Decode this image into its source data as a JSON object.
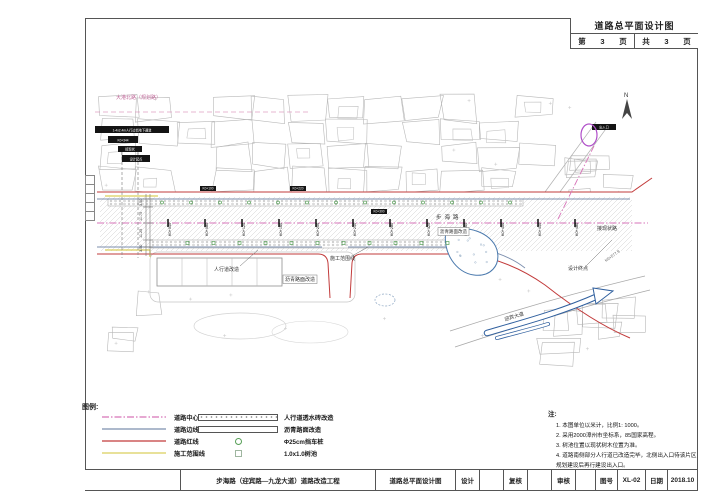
{
  "sheet": {
    "frame_title": "道路总平面设计图",
    "page_row": {
      "p1": "第",
      "p2": "3",
      "p3": "页",
      "p4": "共",
      "p5": "3",
      "p6": "页"
    },
    "bottom_bar": {
      "project": "步海路（迎宾路—九龙大道）道路改造工程",
      "drawing_title": "道路总平面设计图",
      "design_label": "设计",
      "check_label": "复核",
      "review_label": "审核",
      "no_label": "图号",
      "no_value": "XL-02",
      "date_label": "日期",
      "date_value": "2018.10"
    }
  },
  "legend": {
    "heading": "图例:",
    "line_items": [
      {
        "label": "道路中心线",
        "color": "#d773b8",
        "dash": "7 2 1.5 2"
      },
      {
        "label": "道路边线",
        "color": "#7c8fae",
        "dash": ""
      },
      {
        "label": "道路红线",
        "color": "#c23b3b",
        "dash": ""
      },
      {
        "label": "施工范围线",
        "color": "#d9cf5c",
        "dash": ""
      }
    ],
    "symbol_items": [
      {
        "label": "人行道透水砖改造",
        "swatch": "brick"
      },
      {
        "label": "沥青路面改造",
        "swatch": "plain"
      },
      {
        "label": "Φ25cm挡车桩",
        "swatch": "circle"
      },
      {
        "label": "1.0x1.0树池",
        "swatch": "square"
      }
    ]
  },
  "notes": {
    "heading": "注:",
    "items": [
      "1. 本图单位以米计，比例1: 1000。",
      "2. 采用2000漳州市坐标系，85国家高程。",
      "3. 树池位置以现状树木位置为准。",
      "4. 道路南侧部分人行道已改造完毕，北侧出入口待该片区规划建设后再行建设出入口。"
    ]
  },
  "map": {
    "stations": [
      {
        "x": 168,
        "label": "K0+040"
      },
      {
        "x": 205,
        "label": "K0+080"
      },
      {
        "x": 242,
        "label": "K0+120"
      },
      {
        "x": 279,
        "label": "K0+160"
      },
      {
        "x": 316,
        "label": "K0+200"
      },
      {
        "x": 353,
        "label": "K0+240"
      },
      {
        "x": 390,
        "label": "K0+280"
      },
      {
        "x": 427,
        "label": "K0+320"
      },
      {
        "x": 464,
        "label": "K0+360"
      },
      {
        "x": 501,
        "label": "K0+400"
      },
      {
        "x": 538,
        "label": "K0+440"
      },
      {
        "x": 575,
        "label": "K0+480"
      }
    ],
    "black_boxes": [
      {
        "x": 95,
        "y": 126,
        "w": 74,
        "h": 7,
        "text": "1-4x2.4m人行过街地下通道"
      },
      {
        "x": 108,
        "y": 136,
        "w": 30,
        "h": 7,
        "text": "K0+344"
      },
      {
        "x": 118,
        "y": 146,
        "w": 24,
        "h": 6,
        "text": "接现状"
      },
      {
        "x": 122,
        "y": 155,
        "w": 28,
        "h": 7,
        "text": "设计起点"
      },
      {
        "x": 200,
        "y": 186,
        "w": 16,
        "h": 5,
        "text": "K0+100"
      },
      {
        "x": 290,
        "y": 186,
        "w": 16,
        "h": 5,
        "text": "K0+220"
      },
      {
        "x": 371,
        "y": 209,
        "w": 16,
        "h": 5,
        "text": "K0+300"
      },
      {
        "x": 592,
        "y": 124,
        "w": 24,
        "h": 6,
        "text": "出入口"
      }
    ],
    "labels": [
      {
        "text": "大港北路（规划路）",
        "x": 116,
        "y": 99,
        "size": 5,
        "color": "#c06a9a"
      },
      {
        "text": "步海路",
        "x": 436,
        "y": 219,
        "size": 5.5,
        "color": "#333",
        "ls": 3
      },
      {
        "text": "人行道改造",
        "x": 214,
        "y": 271,
        "size": 5,
        "color": "#333"
      },
      {
        "text": "沥青路面改造",
        "x": 285,
        "y": 281,
        "size": 5,
        "color": "#333",
        "boxed": true
      },
      {
        "text": "沥青路面改造",
        "x": 440,
        "y": 233,
        "size": 4.5,
        "color": "#333",
        "boxed": true
      },
      {
        "text": "施工范围线",
        "x": 330,
        "y": 260,
        "size": 5,
        "color": "#333"
      },
      {
        "text": "接现状路",
        "x": 597,
        "y": 230,
        "size": 5,
        "color": "#333"
      },
      {
        "text": "设计终点",
        "x": 568,
        "y": 270,
        "size": 5,
        "color": "#333"
      },
      {
        "text": "迎宾大道",
        "x": 505,
        "y": 321,
        "size": 5,
        "color": "#333",
        "rot": -17
      },
      {
        "text": "K0+577.9",
        "x": 606,
        "y": 262,
        "size": 4,
        "color": "#555",
        "rot": -35
      },
      {
        "text": "N",
        "x": 624,
        "y": 97,
        "size": 6,
        "color": "#333"
      }
    ],
    "dims": [
      {
        "x": 142,
        "y": 206,
        "text": "3.50"
      },
      {
        "x": 142,
        "y": 221,
        "text": "11.75"
      },
      {
        "x": 142,
        "y": 238,
        "text": "11.25"
      },
      {
        "x": 142,
        "y": 252,
        "text": "3.50"
      }
    ]
  }
}
